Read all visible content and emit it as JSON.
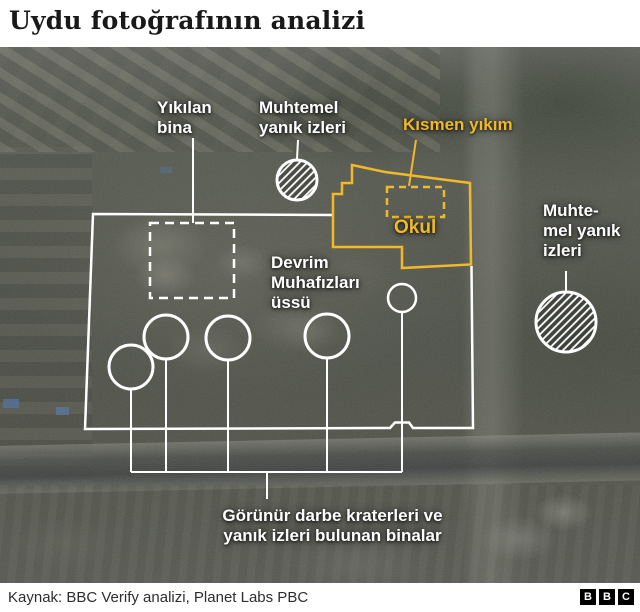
{
  "header": {
    "title": "Uydu fotoğrafının analizi"
  },
  "image": {
    "labels": {
      "destroyed_building": "Yıkılan\nbina",
      "possible_burn_marks_top": "Muhtemel\nyanık izleri",
      "partial_destruction": "Kısmen yıkım",
      "school": "Okul",
      "guard_base": "Devrim\nMuhafızları\nüssü",
      "possible_burn_marks_right": "Muhte-\nmel yanık\nizleri",
      "impact_craters": "Görünür darbe kraterleri ve\nyanık izleri bulunan binalar"
    }
  },
  "footer": {
    "source": "Kaynak: BBC Verify analizi, Planet Labs PBC",
    "logo": [
      "B",
      "B",
      "C"
    ]
  },
  "colors": {
    "accent_yellow": "#F1B929",
    "annotation_white": "#FFFFFF",
    "title_color": "#191919"
  }
}
